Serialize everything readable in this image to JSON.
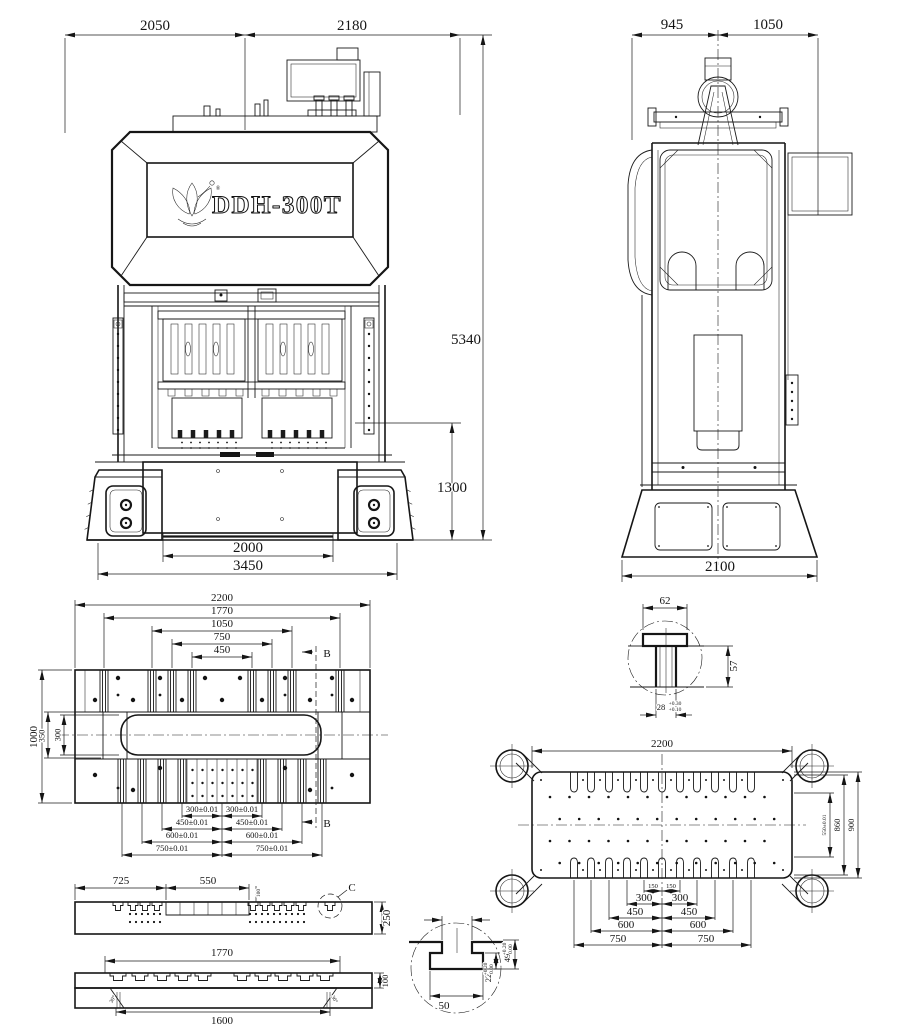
{
  "front": {
    "logo_text": "DDH-300T",
    "logo_reg": "®",
    "w_left": "2050",
    "w_right": "2180",
    "h_total": "5340",
    "h_stroke": "1300",
    "w_bolster": "2000",
    "w_base": "3450"
  },
  "side": {
    "w_left": "945",
    "w_right": "1050",
    "w_base": "2100"
  },
  "bolster": {
    "d2200": "2200",
    "d1770": "1770",
    "d1050": "1050",
    "d750": "750",
    "d450": "450",
    "v1000": "1000",
    "v350": "350",
    "v300": "300",
    "b300l": "300±0.01",
    "b300r": "300±0.01",
    "b450l": "450±0.01",
    "b450r": "450±0.01",
    "b600l": "600±0.01",
    "b600r": "600±0.01",
    "b750l": "750±0.01",
    "b750r": "750±0.01",
    "sec_top": "B",
    "sec_bot": "B"
  },
  "tnut": {
    "w": "62",
    "h": "57",
    "slot": "28",
    "tol_u": "+0.30",
    "tol_l": "+0.10"
  },
  "slide": {
    "w": "2200",
    "h900": "900",
    "h860": "860",
    "h550": "550±0.01",
    "r150l": "150",
    "r150r": "150",
    "r300l": "300",
    "r300r": "300",
    "r450l": "450",
    "r450r": "450",
    "r600l": "600",
    "r600r": "600",
    "r750l": "750",
    "r750r": "750"
  },
  "secA": {
    "d725": "725",
    "d550": "550",
    "d100": "100",
    "d250": "250",
    "label": "C"
  },
  "secB": {
    "d1770": "1770",
    "d1600": "1600",
    "d100": "100",
    "ang_l": "30°",
    "ang_r": "30°"
  },
  "tslot": {
    "d50": "50",
    "d22": "22",
    "t22u": "+0.20",
    "t22l": "0.00",
    "d49": "49",
    "t49u": "+0.20",
    "t49l": "0.00"
  }
}
